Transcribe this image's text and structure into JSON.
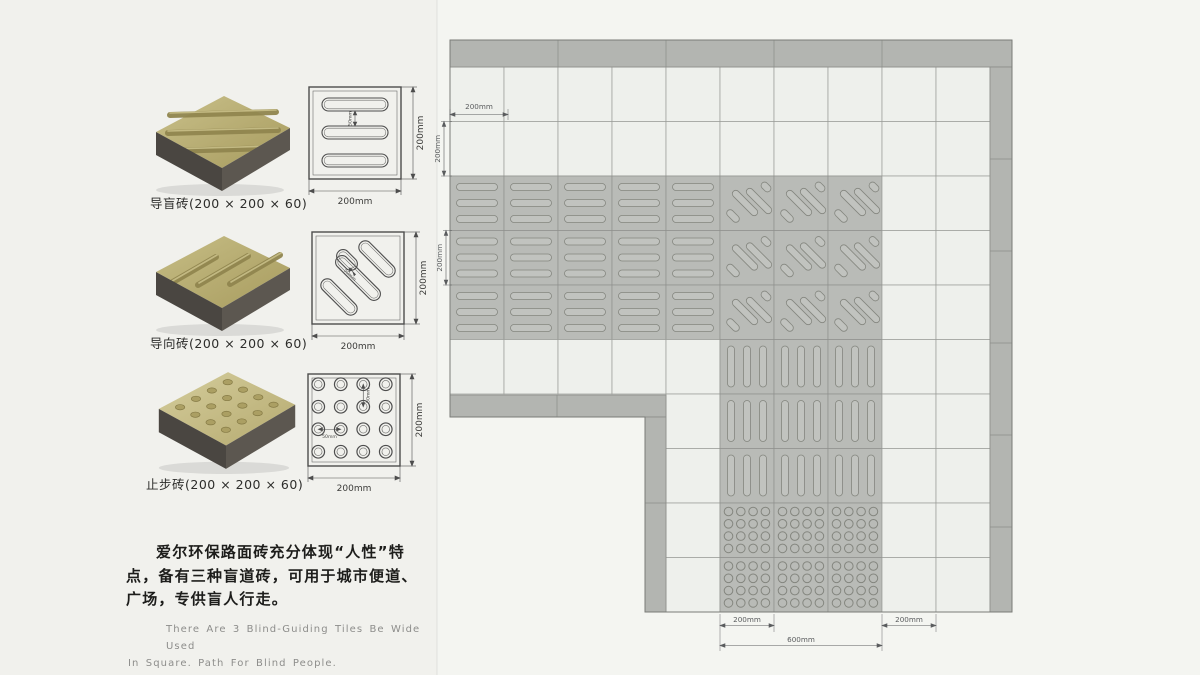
{
  "products": [
    {
      "label": "导盲砖(200 × 200 × 60)",
      "pattern": "horizontal-bars"
    },
    {
      "label": "导向砖(200 × 200 × 60)",
      "pattern": "diagonal-bars"
    },
    {
      "label": "止步砖(200 × 200 × 60)",
      "pattern": "dots"
    }
  ],
  "drawings": [
    {
      "width_label": "200mm",
      "height_label": "200mm",
      "inner_label": "50mm"
    },
    {
      "width_label": "200mm",
      "height_label": "200mm",
      "inner_label": "50mm"
    },
    {
      "width_label": "200mm",
      "height_label": "200mm",
      "inner_h_label": "50mm",
      "inner_v_label": "50mm"
    }
  ],
  "description_cn": {
    "line1": "爱尔环保路面砖充分体现“人性”特",
    "line2": "点，备有三种盲道砖，可用于城市便道、",
    "line3": "广场，专供盲人行走。"
  },
  "description_en": {
    "line1": "There Are 3 Blind-Guiding Tiles Be Wide Used",
    "line2": "In Square. Path For Blind People."
  },
  "plan": {
    "dim_top": "200mm",
    "dim_left_upper": "200mm",
    "dim_left_lower": "200mm",
    "dim_bottom_tile": "200mm",
    "dim_bottom_path": "600mm",
    "dim_bottom_right": "200mm",
    "colors": {
      "tile_white": "#eef0ec",
      "tile_pattern": "#b9bbb7",
      "tile_border": "#b3b5b1",
      "grid_line": "#9a9c98",
      "pattern_line": "#84867f",
      "glyph_fill": "#c1c3bf",
      "outline": "#7a7c78",
      "dim": "#5a5c5e"
    }
  }
}
